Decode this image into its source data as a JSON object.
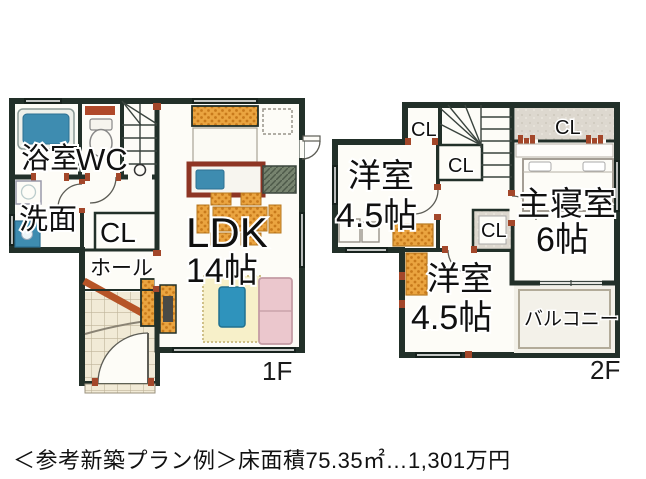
{
  "caption": {
    "text": "＜参考新築プラン例＞床面積75.35㎡…1,301万円"
  },
  "floor1": {
    "name": "1F",
    "rooms": {
      "bath": "浴室",
      "toilet": "WC",
      "washroom": "洗面",
      "closet": "CL",
      "hall": "ホール",
      "ldk": "LDK",
      "ldk_size": "14帖"
    }
  },
  "floor2": {
    "name": "2F",
    "rooms": {
      "west_room_a": "洋室",
      "west_room_a_size": "4.5帖",
      "closet_top": "CL",
      "closet_mid": "CL",
      "closet_lower": "CL",
      "closet_master": "CL",
      "master": "主寝室",
      "master_size": "6帖",
      "west_room_b": "洋室",
      "west_room_b_size": "4.5帖",
      "balcony": "バルコニー"
    }
  },
  "colors": {
    "wall": "#223029",
    "door_accent": "#a3472a",
    "furniture_orange": "#eaa440",
    "water_blue": "#3e8cb0",
    "sofa_pink": "#ebc7cd",
    "rug_cream": "#f7f0c9",
    "tile_beige": "#f1ead6",
    "closet_gray": "#ddd8cf",
    "table_blue": "#2f93bc"
  }
}
